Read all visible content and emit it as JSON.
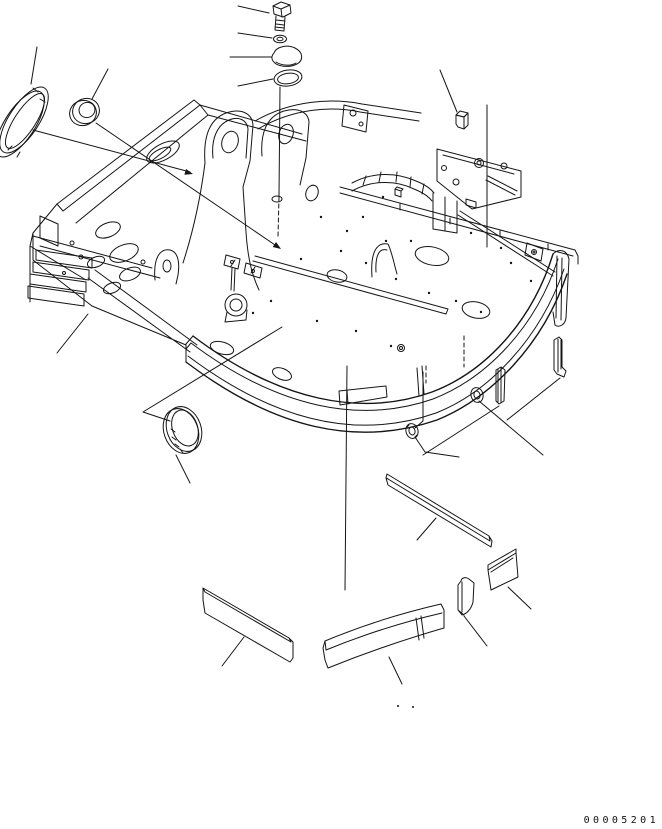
{
  "page": {
    "background_color": "#ffffff",
    "line_color": "#151515",
    "kind": "exploded-parts-line-drawing"
  },
  "footer": {
    "drawing_number": "00005201"
  },
  "parts": [
    {
      "name": "hex-bolt"
    },
    {
      "name": "flat-washer"
    },
    {
      "name": "cap"
    },
    {
      "name": "seal-ring"
    },
    {
      "name": "oval-seal-ring"
    },
    {
      "name": "round-grommet"
    },
    {
      "name": "rubber-block"
    },
    {
      "name": "revolving-frame"
    },
    {
      "name": "wear-ring"
    },
    {
      "name": "deck-grommet"
    },
    {
      "name": "grommet-left"
    },
    {
      "name": "grommet-right"
    },
    {
      "name": "shim-strip-small"
    },
    {
      "name": "shim-strip-large"
    },
    {
      "name": "square-bar"
    },
    {
      "name": "flat-side-plate"
    },
    {
      "name": "curved-front-plate"
    },
    {
      "name": "corner-plate"
    },
    {
      "name": "wedge-block"
    }
  ]
}
